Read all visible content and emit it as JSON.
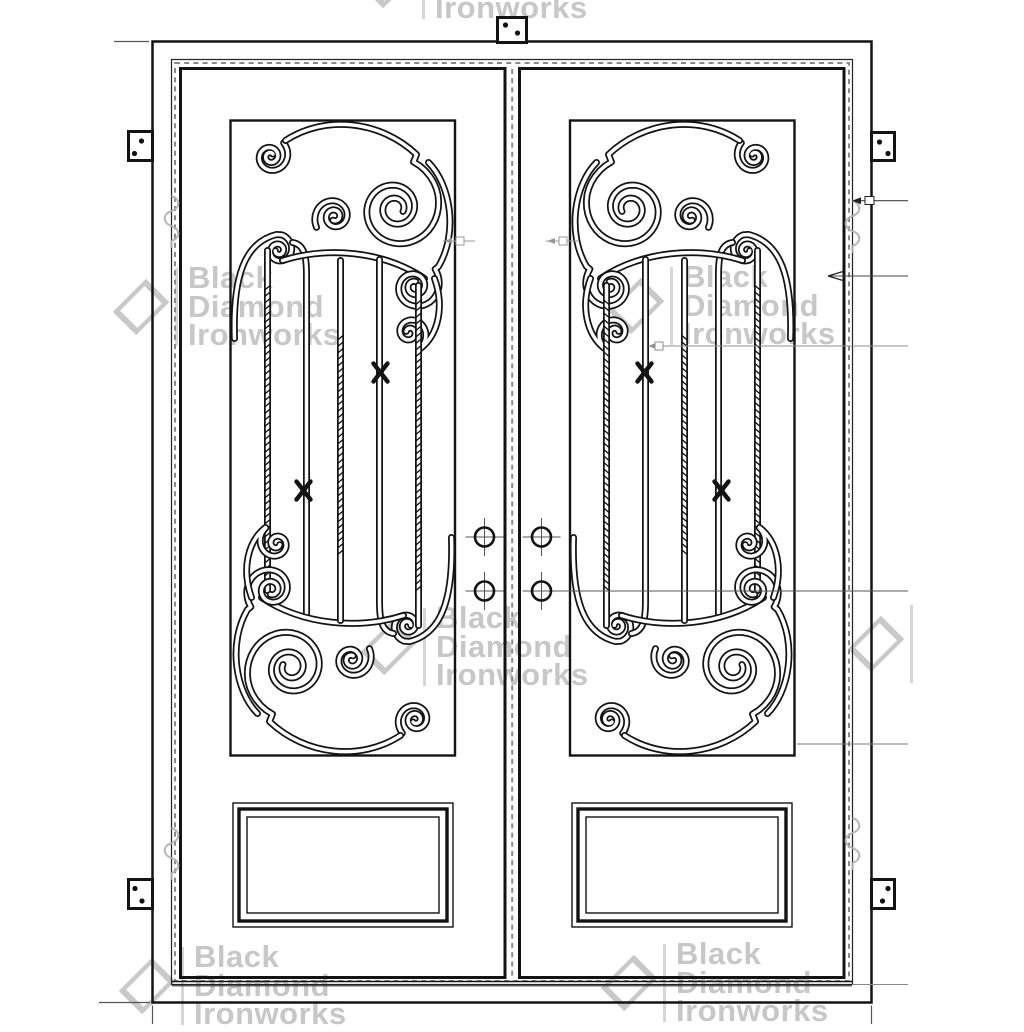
{
  "watermark": {
    "line1": "Black",
    "line2": "Diamond",
    "line3": "Ironworks",
    "brand": "Black Diamond Ironworks",
    "color": "#c7c7c7",
    "tile_count": 7
  },
  "drawing": {
    "line_color": "#141414",
    "weatherstrip_dash_color": "#8a8a8a",
    "leader_line_color": "#444444",
    "dimension_marker_color": "#999999",
    "hinge_symbol_color": "#b3b3b3",
    "door_leaf_count": 2,
    "scroll_panel_count": 2,
    "bottom_panel_count": 2,
    "lock_prep_hole_count": 4,
    "hinge_plate_count": 4,
    "top_bracket_count": 1,
    "leader_line_count": 6
  },
  "icons": {
    "diamond_logo": "rotated-square-outline",
    "hinge_plate": "square-plate-with-two-screw-dots",
    "lock_prep_hole": "circle-with-crosshair",
    "hinge_symbol": "gray-barrel-hinge-squiggle"
  }
}
